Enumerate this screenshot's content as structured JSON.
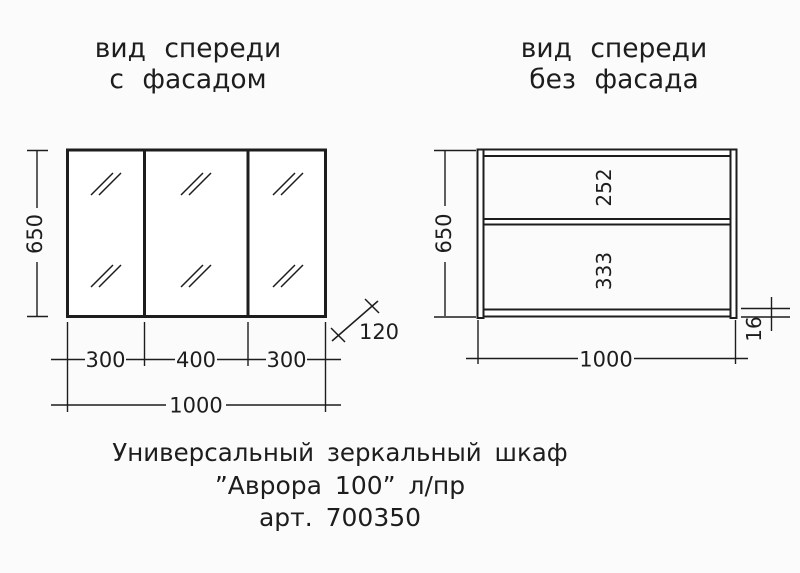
{
  "colors": {
    "line": "#1d1d1d",
    "background": "#fbfbfb"
  },
  "left_view": {
    "title": {
      "line1": "вид спереди",
      "line2": "с фасадом"
    },
    "dimensions": {
      "height": "650",
      "door_left": "300",
      "door_center": "400",
      "door_right": "300",
      "total_width": "1000",
      "depth": "120"
    }
  },
  "right_view": {
    "title": {
      "line1": "вид спереди",
      "line2": "без фасада"
    },
    "dimensions": {
      "height": "650",
      "upper_section": "252",
      "lower_section": "333",
      "total_width": "1000",
      "panel_thickness": "16"
    }
  },
  "caption": {
    "line1": "Универсальный зеркальный шкаф",
    "line2": "”Аврора 100” л/пр",
    "line3": "арт. 700350"
  }
}
